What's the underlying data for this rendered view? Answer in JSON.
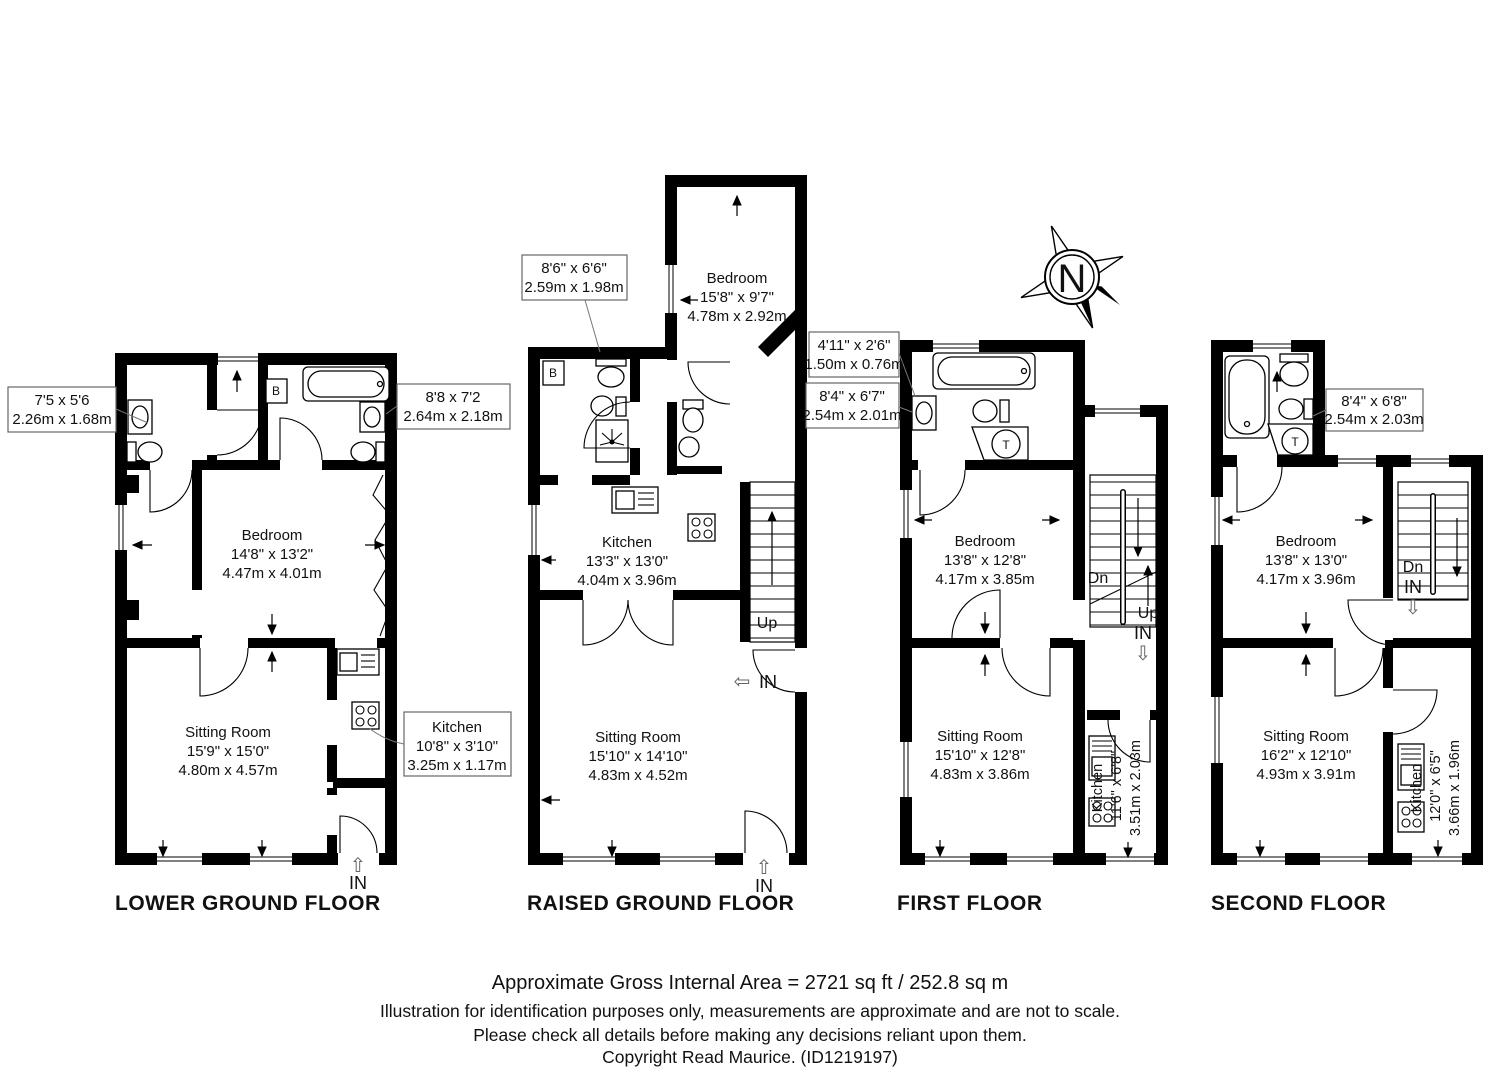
{
  "compass": {
    "north": "N"
  },
  "arrows": {
    "up_hollow": "⇧",
    "down_hollow": "⇩",
    "left_hollow": "⇦"
  },
  "floors": [
    {
      "label": "LOWER GROUND FLOOR",
      "rooms": {
        "bedroom": {
          "name": "Bedroom",
          "imperial": "14'8\" x 13'2\"",
          "metric": "4.47m x 4.01m"
        },
        "sitting": {
          "name": "Sitting Room",
          "imperial": "15'9\" x 15'0\"",
          "metric": "4.80m x 4.57m"
        }
      },
      "callouts": {
        "bath_left": {
          "imperial": "7'5 x 5'6",
          "metric": "2.26m x 1.68m"
        },
        "bath_right": {
          "imperial": "8'8 x 7'2",
          "metric": "2.64m x 2.18m"
        },
        "kitchen": {
          "name": "Kitchen",
          "imperial": "10'8\" x 3'10\"",
          "metric": "3.25m x 1.17m"
        }
      },
      "markers": {
        "entrance": "IN",
        "boiler": "B"
      }
    },
    {
      "label": "RAISED GROUND FLOOR",
      "rooms": {
        "bedroom": {
          "name": "Bedroom",
          "imperial": "15'8\" x 9'7\"",
          "metric": "4.78m x 2.92m"
        },
        "kitchen": {
          "name": "Kitchen",
          "imperial": "13'3\" x 13'0\"",
          "metric": "4.04m x 3.96m"
        },
        "sitting": {
          "name": "Sitting Room",
          "imperial": "15'10\" x 14'10\"",
          "metric": "4.83m x 4.52m"
        }
      },
      "callouts": {
        "shower_room": {
          "imperial": "8'6\" x 6'6\"",
          "metric": "2.59m x 1.98m"
        }
      },
      "markers": {
        "up": "Up",
        "entrance_side": "IN",
        "entrance_front": "IN",
        "boiler": "B"
      }
    },
    {
      "label": "FIRST FLOOR",
      "rooms": {
        "bedroom": {
          "name": "Bedroom",
          "imperial": "13'8\" x 12'8\"",
          "metric": "4.17m x 3.85m"
        },
        "sitting": {
          "name": "Sitting Room",
          "imperial": "15'10\" x 12'8\"",
          "metric": "4.83m x 3.86m"
        },
        "kitchen": {
          "name": "Kitchen",
          "imperial": "11'6\" x 6'8\"",
          "metric": "3.51m x 2.03m"
        }
      },
      "callouts": {
        "cupboard": {
          "imperial": "4'11\" x 2'6\"",
          "metric": "1.50m x 0.76m"
        },
        "bathroom": {
          "imperial": "8'4\" x 6'7\"",
          "metric": "2.54m x 2.01m"
        }
      },
      "markers": {
        "dn": "Dn",
        "up": "Up",
        "entrance": "IN",
        "tank": "T"
      }
    },
    {
      "label": "SECOND FLOOR",
      "rooms": {
        "bedroom": {
          "name": "Bedroom",
          "imperial": "13'8\" x 13'0\"",
          "metric": "4.17m x 3.96m"
        },
        "sitting": {
          "name": "Sitting Room",
          "imperial": "16'2\" x 12'10\"",
          "metric": "4.93m x 3.91m"
        },
        "kitchen": {
          "name": "Kitchen",
          "imperial": "12'0\" x 6'5\"",
          "metric": "3.66m x 1.96m"
        }
      },
      "callouts": {
        "bathroom": {
          "imperial": "8'4\" x 6'8\"",
          "metric": "2.54m x 2.03m"
        }
      },
      "markers": {
        "dn": "Dn",
        "entrance": "IN",
        "tank": "T"
      }
    }
  ],
  "footer": {
    "area": "Approximate Gross Internal Area = 2721 sq ft / 252.8 sq m",
    "disclaimer_line1": "Illustration for identification purposes only, measurements are approximate and are not to scale.",
    "disclaimer_line2": "Please check all details before making any decisions reliant upon them.",
    "copyright": "Copyright Read Maurice. (ID1219197)"
  }
}
